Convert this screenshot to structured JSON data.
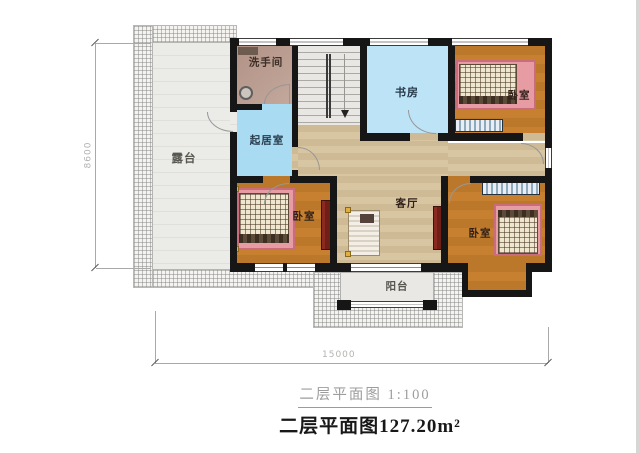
{
  "rooms": {
    "terrace": {
      "label": "露台"
    },
    "washroom": {
      "label": "洗手间"
    },
    "lounge": {
      "label": "起居室"
    },
    "study": {
      "label": "书房"
    },
    "bedroom_top_right": {
      "label": "卧室"
    },
    "bedroom_bottom_left": {
      "label": "卧室"
    },
    "bedroom_bottom_right": {
      "label": "卧室"
    },
    "living_room": {
      "label": "客厅"
    },
    "balcony": {
      "label": "阳台"
    }
  },
  "dimensions": {
    "left": "8600",
    "bottom": "15000"
  },
  "titles": {
    "scale_caption": "二层平面图 1:100",
    "area_caption": "二层平面图127.20m²"
  },
  "colors": {
    "wall": "#161616",
    "bedroom-floor": "#c6802f",
    "hall-floor": "#d8c6a2",
    "study-floor": "#bce4f6",
    "lounge-floor": "#a9dcf2",
    "washroom-floor": "#b29286",
    "bed-pink": "#e79ca4",
    "bed-pink-border": "#c96d7d",
    "mattress": "#efe6cf",
    "dresser-maroon": "#6f1f16",
    "dim-color": "#b3b3b1"
  }
}
